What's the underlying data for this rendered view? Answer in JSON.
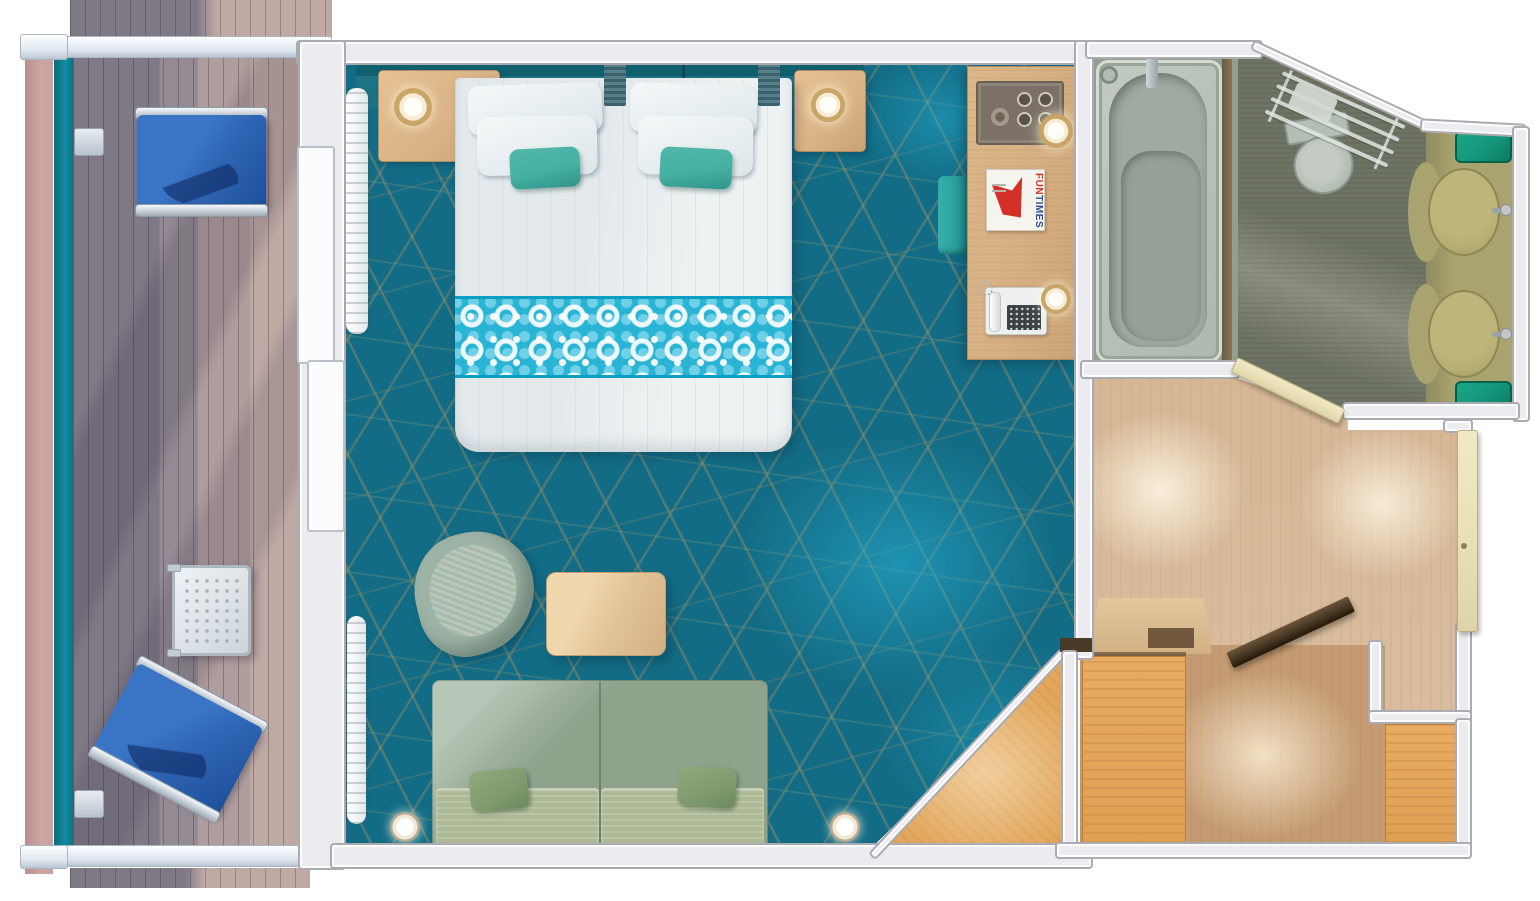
{
  "magazine": {
    "title_fun": "FUN",
    "title_times": "TIMES"
  },
  "colors": {
    "carpet": "#136c85",
    "carpet_web": "#a79263",
    "carpet_glow": "#27b2d6",
    "headboard_dark": "#10606f",
    "headboard": "#1d7386",
    "bed_white": "#eef2f3",
    "runner_teal": "#29b3d5",
    "pillow_teal": "#46b0a2",
    "sofa_back": "#8ea28c",
    "sofa_seat": "#adb995",
    "sofa_pillow": "#7e9a6e",
    "armchair": "#9db3a6",
    "table_wood": "#e2c298",
    "nightstand_wood": "#d9b285",
    "desk_wood": "#d6af83",
    "tray_dark": "#7b7166",
    "ottoman_teal": "#2aa09d",
    "lamp_ring": "#c9a568",
    "funtimes_red": "#d43028",
    "funtimes_blue": "#2b4e9b",
    "deck_gray": "#7f7986",
    "deck_pink": "#bfa9a5",
    "hull_pink": "#cda5a3",
    "balcony_teal": "#0d7387",
    "lounge_blue": "#2f66b5",
    "lounge_blue_dark": "#1d4f9a",
    "metal_light": "#e8edf2",
    "wall_fill": "#ececf0",
    "wall_edge": "#ababb2",
    "tub_gray": "#aeb8ae",
    "bath_floor": "#6e7463",
    "toilet_gray": "#c4ccc4",
    "vanity_olive": "#a9a36f",
    "sink_tan": "#b5ad72",
    "green_accent": "#14967a",
    "hall_wood": "#d9bd9e",
    "closet_wood": "#c49b72",
    "wardrobe_wood": "#e0a054",
    "door_cream": "#e9e0b6",
    "door_dark": "#43331f",
    "glow_warm": "#f7ecd9"
  }
}
